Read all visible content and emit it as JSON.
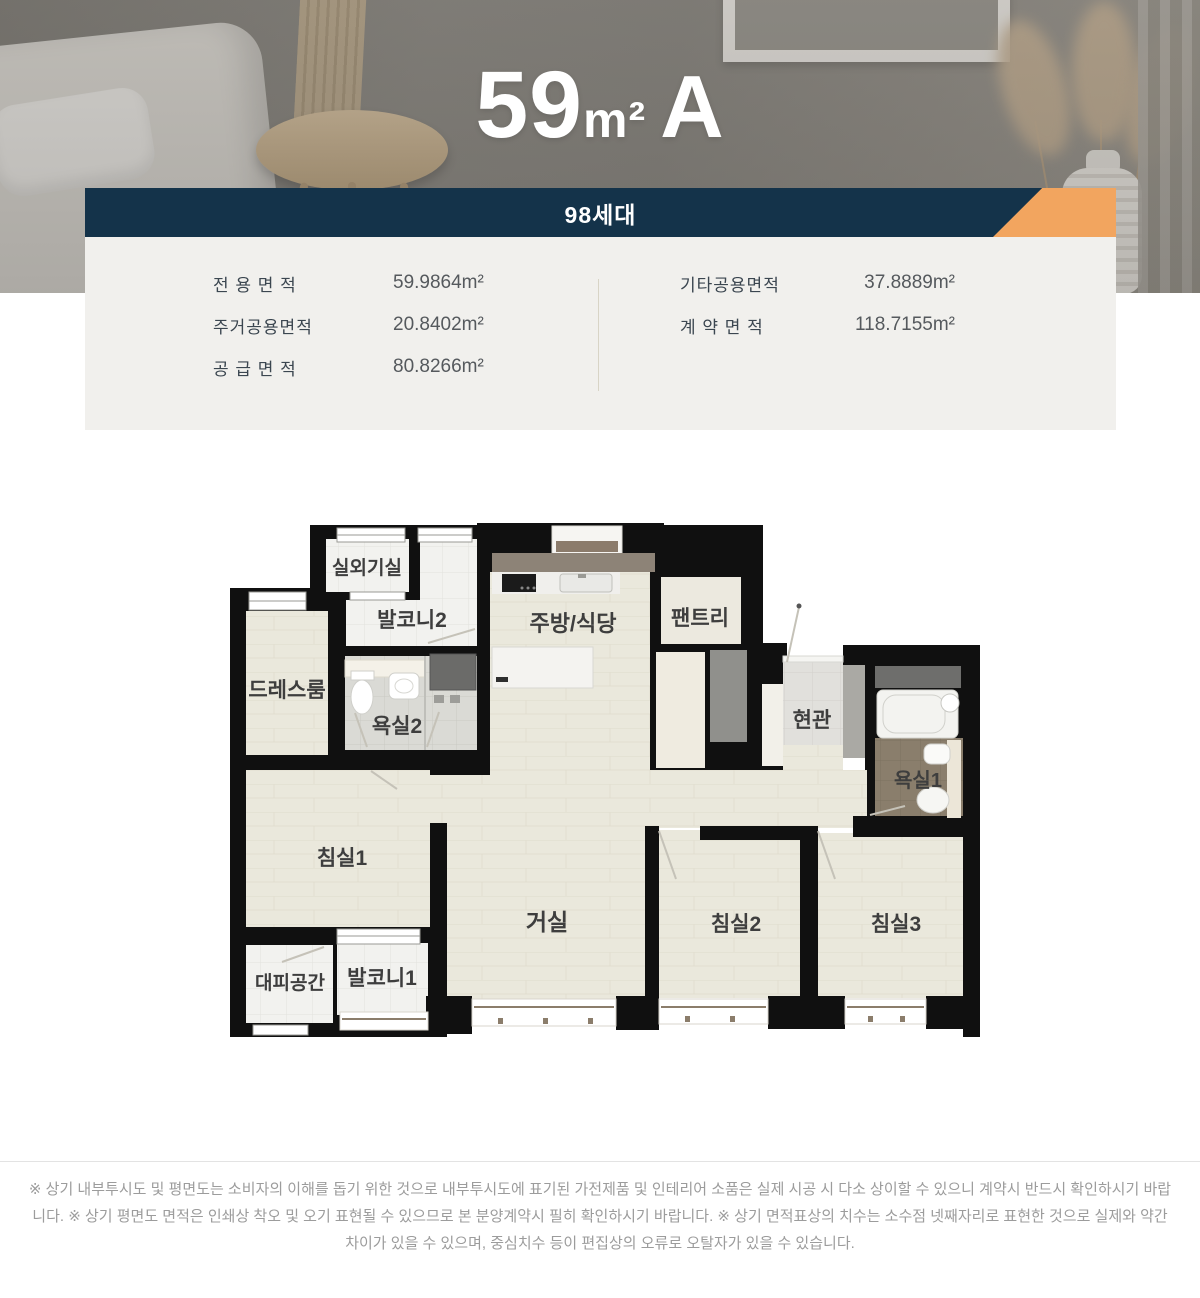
{
  "hero": {
    "title": {
      "number": "59",
      "unit": "m²",
      "variant": "A"
    }
  },
  "banner": {
    "households": "98세대",
    "bg": "#14334a",
    "accent": "#f2a55f"
  },
  "area_table": {
    "left": [
      {
        "label": "전 용 면 적",
        "value": "59.9864m²"
      },
      {
        "label": "주거공용면적",
        "value": "20.8402m²"
      },
      {
        "label": "공 급 면 적",
        "value": "80.8266m²"
      }
    ],
    "right": [
      {
        "label": "기타공용면적",
        "value": "37.8889m²"
      },
      {
        "label": "계 약 면 적",
        "value": "118.7155m²"
      }
    ]
  },
  "floorplan": {
    "rooms": [
      {
        "id": "outdoor-unit-room",
        "label": "실외기실"
      },
      {
        "id": "balcony2",
        "label": "발코니2"
      },
      {
        "id": "kitchen-dining",
        "label": "주방/식당"
      },
      {
        "id": "pantry",
        "label": "팬트리"
      },
      {
        "id": "dress-room",
        "label": "드레스룸"
      },
      {
        "id": "bathroom2",
        "label": "욕실2"
      },
      {
        "id": "entrance",
        "label": "현관"
      },
      {
        "id": "bathroom1",
        "label": "욕실1"
      },
      {
        "id": "bedroom1",
        "label": "침실1"
      },
      {
        "id": "living-room",
        "label": "거실"
      },
      {
        "id": "bedroom2",
        "label": "침실2"
      },
      {
        "id": "bedroom3",
        "label": "침실3"
      },
      {
        "id": "shelter",
        "label": "대피공간"
      },
      {
        "id": "balcony1",
        "label": "발코니1"
      }
    ]
  },
  "footer": {
    "disclaimer": "※ 상기 내부투시도 및 평면도는 소비자의 이해를 돕기 위한 것으로 내부투시도에 표기된 가전제품 및 인테리어 소품은 실제 시공 시 다소 상이할 수 있으니 계약시 반드시 확인하시기 바랍니다. ※ 상기 평면도 면적은 인쇄상 착오 및 오기 표현될 수 있으므로 본 분양계약시 필히 확인하시기 바랍니다. ※ 상기 면적표상의 치수는 소수점 넷째자리로 표현한 것으로 실제와 약간 차이가 있을 수 있으며, 중심치수 등이 편집상의 오류로 오탈자가 있을 수 있습니다."
  }
}
